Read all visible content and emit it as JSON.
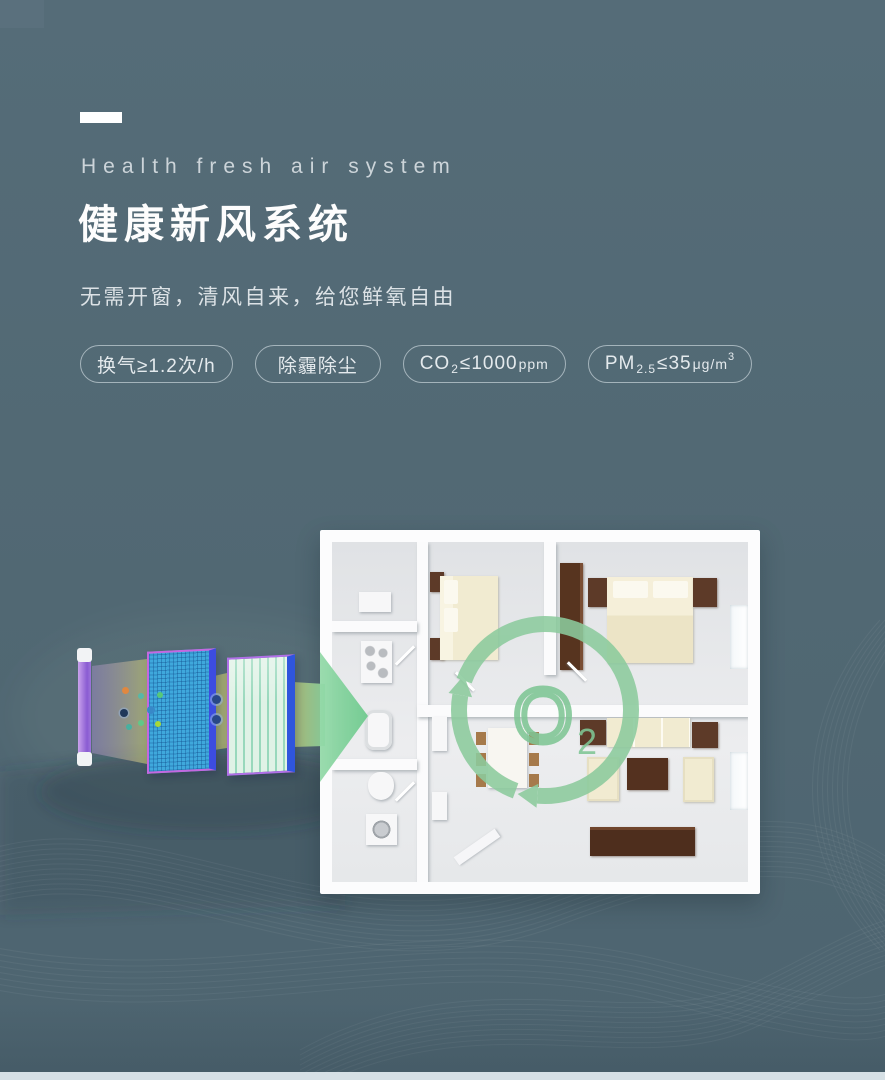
{
  "header": {
    "eyebrow": "Health fresh air system",
    "title": "健康新风系统",
    "subtitle": "无需开窗，清风自来，给您鲜氧自由"
  },
  "badges": [
    {
      "text": "换气≥1.2次/h"
    },
    {
      "text": "除霾除尘"
    },
    {
      "pre": "CO",
      "sub": "2",
      "mid": "≤1000",
      "small": "ppm"
    },
    {
      "pre": "PM",
      "sub": "2.5",
      "mid": "≤35",
      "small": "μg/m",
      "sup": "3"
    }
  ],
  "diagram": {
    "o2_symbol": "O",
    "o2_subscript": "2"
  },
  "icons": {
    "airflow_arrow": "right-pointing triangle",
    "o2_circulation": "circular arrows ring",
    "uv_lamp": "vertical violet tube",
    "mesh_filter": "blue mesh panel",
    "pleated_filter": "green pleated panel",
    "pollution_particles": "colored dots"
  },
  "colors": {
    "background": "#516873",
    "title_white": "#fdfdfd",
    "eyebrow_gray": "#ccd4d9",
    "badge_border": "#d6e2e7",
    "accent_green": "#8ccb9d",
    "beam_yellow": "#c2c272",
    "filter_mesh_blue": "#3fa8dc",
    "filter_frame_purple": "#b070e8",
    "lamp_violet": "#8a5cd2",
    "furniture_wood": "#5d3a28",
    "furniture_cream": "#f1ebd1",
    "floor_gray": "#e8e9eb",
    "bottom_strip": "#d6e0e5"
  }
}
